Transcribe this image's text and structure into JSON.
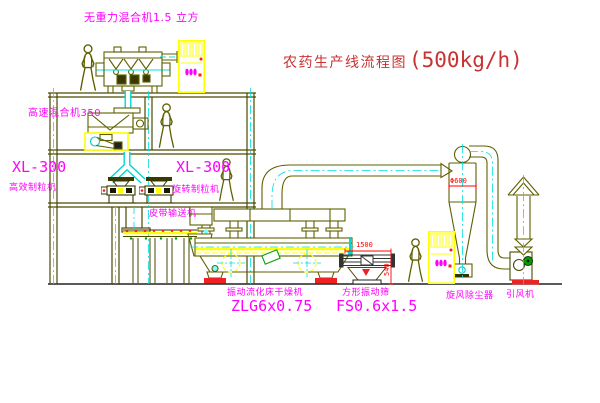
{
  "title": {
    "text": "农药生产线流程图",
    "capacity": "(500kg/h)"
  },
  "labels": {
    "gravity_mixer": "无重力混合机1.5 立方",
    "high_speed_mixer": "高速混合机350",
    "granulator_left_model": "XL-300",
    "granulator_left_name": "高效制粒机",
    "granulator_right_model": "XL-300",
    "granulator_right_name": "旋转制粒机",
    "belt_conveyor": "皮带输送机",
    "dryer_name": "振动流化床干燥机",
    "dryer_model": "ZLG6x0.75",
    "screen_name": "方形振动筛",
    "screen_model": "FS0.6x1.5",
    "cyclone_name": "旋风除尘器",
    "fan_name": "引风机"
  },
  "dimensions": {
    "screen_length": "1500",
    "screen_height": "540",
    "cyclone_diameter": "Φ600"
  },
  "colors": {
    "background": "#ffffff",
    "label_magenta": "#ff00ff",
    "title_red": "#c83232",
    "dimension_red": "#ff0000",
    "line_olive": "#5f5f00",
    "highlight_yellow": "#ffff00",
    "centerline_cyan": "#00e0e0",
    "accent_green": "#00a000",
    "status_red": "#ee2222"
  }
}
